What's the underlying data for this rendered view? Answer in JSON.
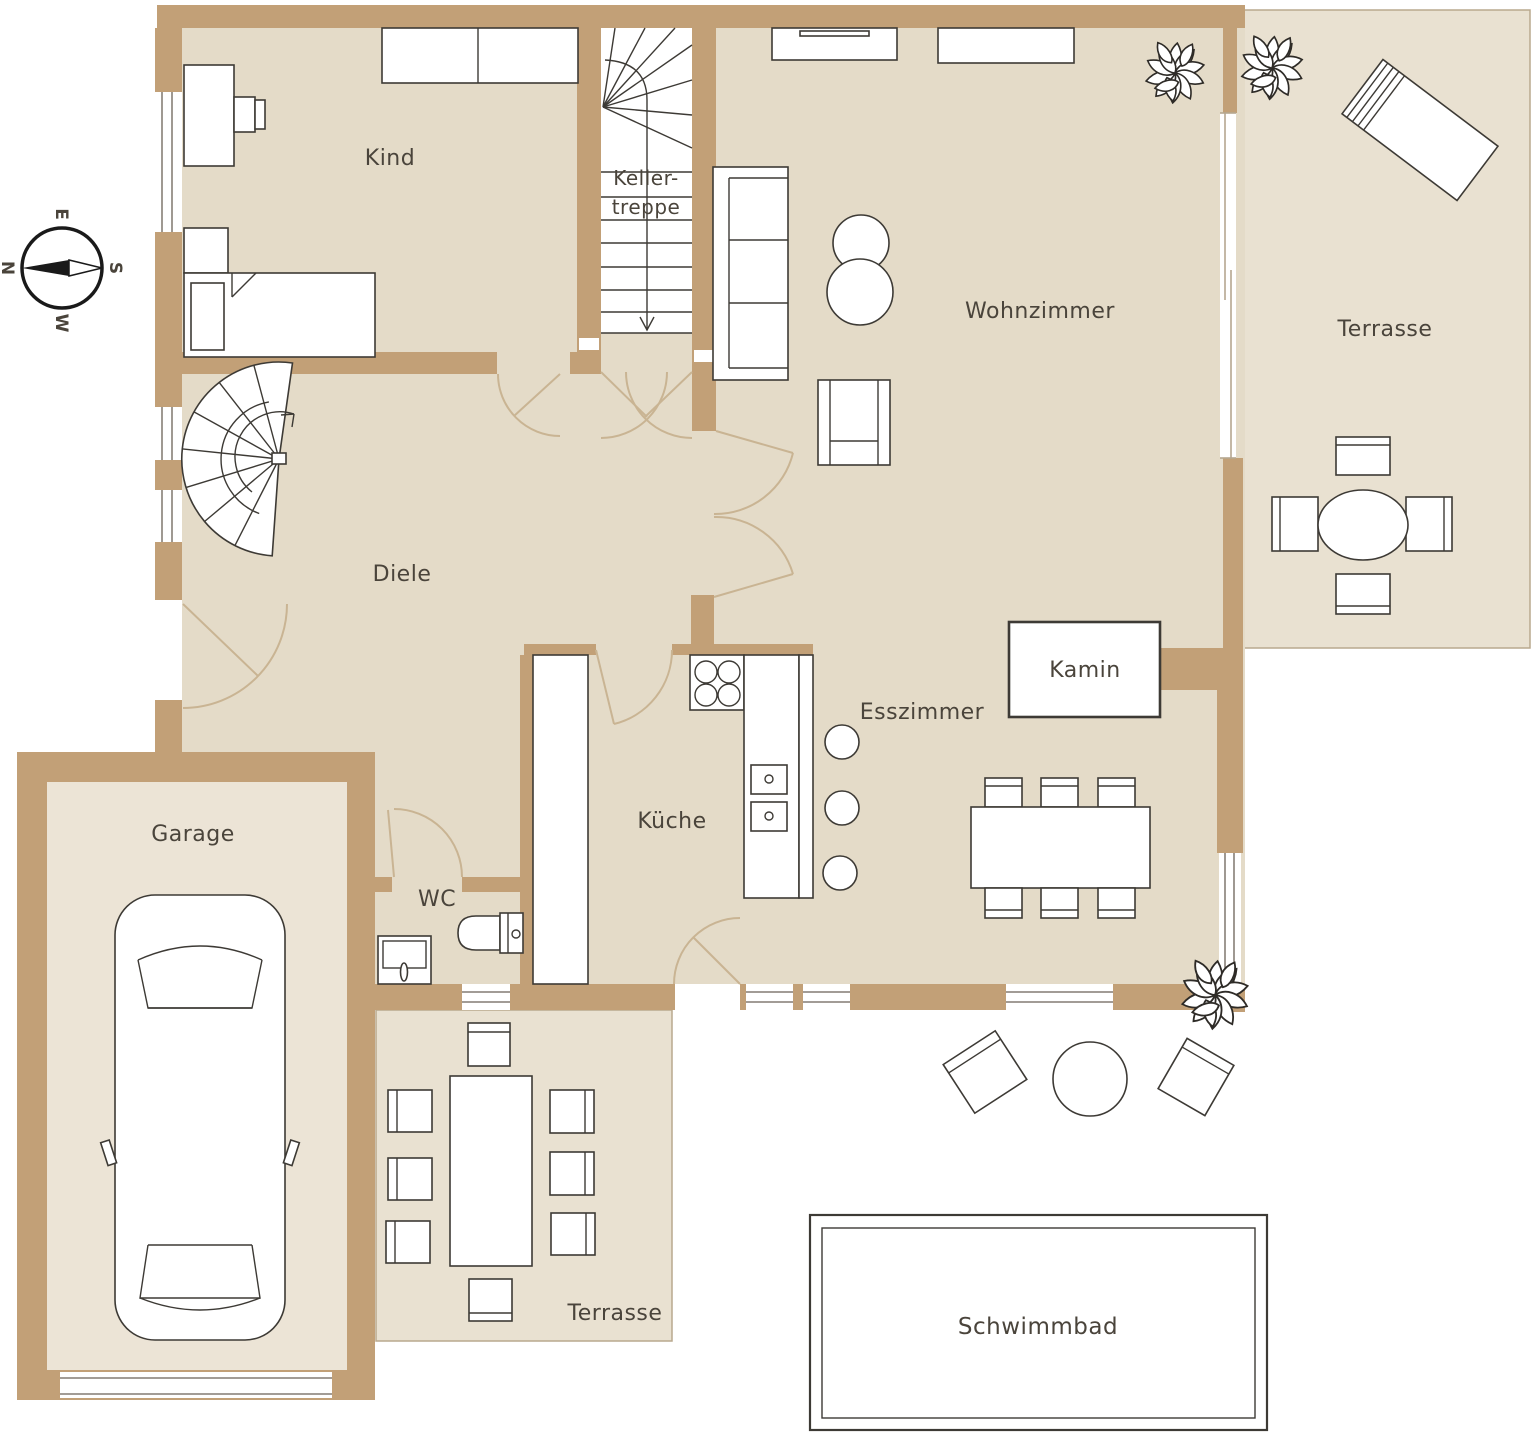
{
  "compass": {
    "north": "N",
    "east": "E",
    "south": "S",
    "west": "W"
  },
  "rooms": {
    "kind": {
      "label": "Kind"
    },
    "kellertreppe": {
      "label_line1": "Keller-",
      "label_line2": "treppe"
    },
    "wohnzimmer": {
      "label": "Wohnzimmer"
    },
    "terrasse_ost": {
      "label": "Terrasse"
    },
    "diele": {
      "label": "Diele"
    },
    "garage": {
      "label": "Garage"
    },
    "wc": {
      "label": "WC"
    },
    "kueche": {
      "label": "Küche"
    },
    "esszimmer": {
      "label": "Esszimmer"
    },
    "kamin": {
      "label": "Kamin"
    },
    "terrasse_sued": {
      "label": "Terrasse"
    },
    "schwimmbad": {
      "label": "Schwimmbad"
    }
  },
  "colors": {
    "wall": "#c2a077",
    "floor": "#e4dbc8",
    "terrace": "#e9e1d1",
    "garage_floor": "#ece4d6",
    "line": "#3d3a35",
    "door_arc": "#c9b493",
    "window_line": "#6b6257",
    "terrace_edge": "#b9a98e",
    "glass": "#b5a78f",
    "text": "#4a443b"
  }
}
